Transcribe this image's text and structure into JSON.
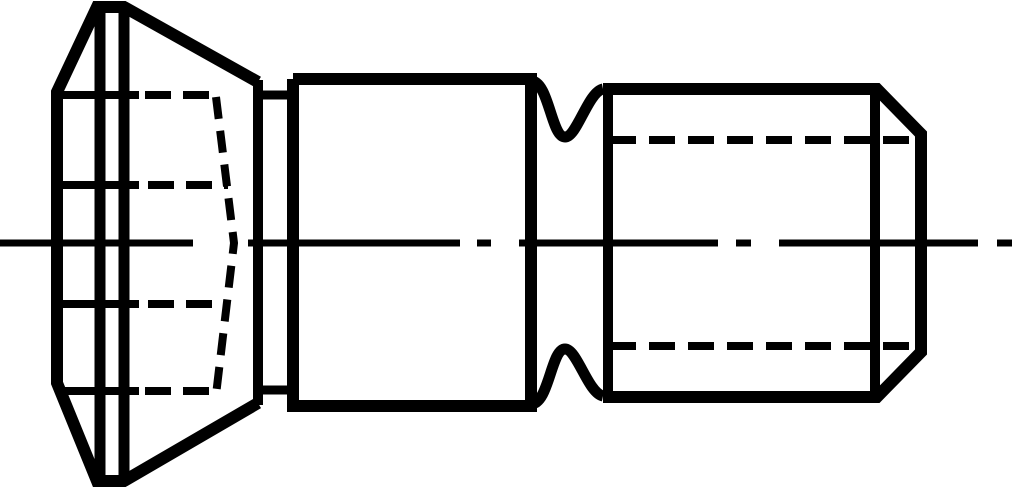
{
  "figure": {
    "type": "technical-drawing",
    "subject": "countersunk-head-shoulder-screw-side-view",
    "background_color": "#ffffff",
    "stroke_color": "#000000",
    "canvas": {
      "width": 1024,
      "height": 493
    },
    "center_axis_y": 243,
    "groups": [
      {
        "name": "center-axis-line",
        "stroke_width": 7,
        "dash": null,
        "paths": [
          "M0 243L193 243",
          "M248 243L460 243",
          "M477 243L491 243",
          "M519 243L718 243",
          "M736 243L751 243",
          "M779 243L978 243",
          "M997 243L1012 243"
        ]
      },
      {
        "name": "head-outline",
        "stroke_width": 12,
        "dash": null,
        "paths": [
          "M258 82L124 7L97 7L57 92L57 383L97 481L124 481L258 403"
        ]
      },
      {
        "name": "head-rim-edge-lines",
        "stroke_width": 11,
        "dash": null,
        "paths": [
          "M100 7L100 481",
          "M124 7L124 481"
        ]
      },
      {
        "name": "head-back-face-edge",
        "stroke_width": 10,
        "dash": null,
        "paths": [
          "M258 80L258 405"
        ]
      },
      {
        "name": "head-undercut-edges",
        "stroke_width": 9,
        "dash": null,
        "paths": [
          "M254 95L297 95",
          "M254 390L297 390"
        ]
      },
      {
        "name": "head-recess-visible-edges",
        "stroke_width": 8,
        "dash": null,
        "paths": [
          "M60 95L139 95",
          "M60 185L139 185",
          "M60 304L139 304",
          "M60 391L139 391"
        ]
      },
      {
        "name": "head-recess-hidden-lines",
        "stroke_width": 8,
        "dash": "26 12",
        "paths": [
          "M145 95L215 95",
          "M148 185L228 185",
          "M148 304L228 304",
          "M145 391L215 391"
        ]
      },
      {
        "name": "head-recess-hidden-cone",
        "stroke_width": 8,
        "dash": "22 12",
        "paths": [
          "M216 97L234 243L216 395"
        ]
      },
      {
        "name": "shoulder-outline",
        "stroke_width": 12,
        "dash": null,
        "paths": [
          "M293 79L531 79L531 406L293 406L293 79"
        ]
      },
      {
        "name": "relief-groove-outline",
        "stroke_width": 11,
        "dash": null,
        "paths": [
          "M531 81C549 81 551 137 565 137C577 137 588 92 603 89",
          "M531 404C549 404 551 349 565 349C577 349 588 393 603 396"
        ]
      },
      {
        "name": "thread-section-outline",
        "stroke_width": 12,
        "dash": null,
        "paths": [
          "M603 89L877 89L921 134L921 352L877 397L603 397"
        ]
      },
      {
        "name": "thread-section-left-edge",
        "stroke_width": 10,
        "dash": null,
        "paths": [
          "M608 89L608 397"
        ]
      },
      {
        "name": "thread-chamfer-edge",
        "stroke_width": 10,
        "dash": null,
        "paths": [
          "M875 89L875 397"
        ]
      },
      {
        "name": "thread-root-hidden-lines",
        "stroke_width": 8,
        "dash": "26 13",
        "paths": [
          "M610 140L909 140",
          "M610 346L909 346"
        ]
      }
    ]
  }
}
